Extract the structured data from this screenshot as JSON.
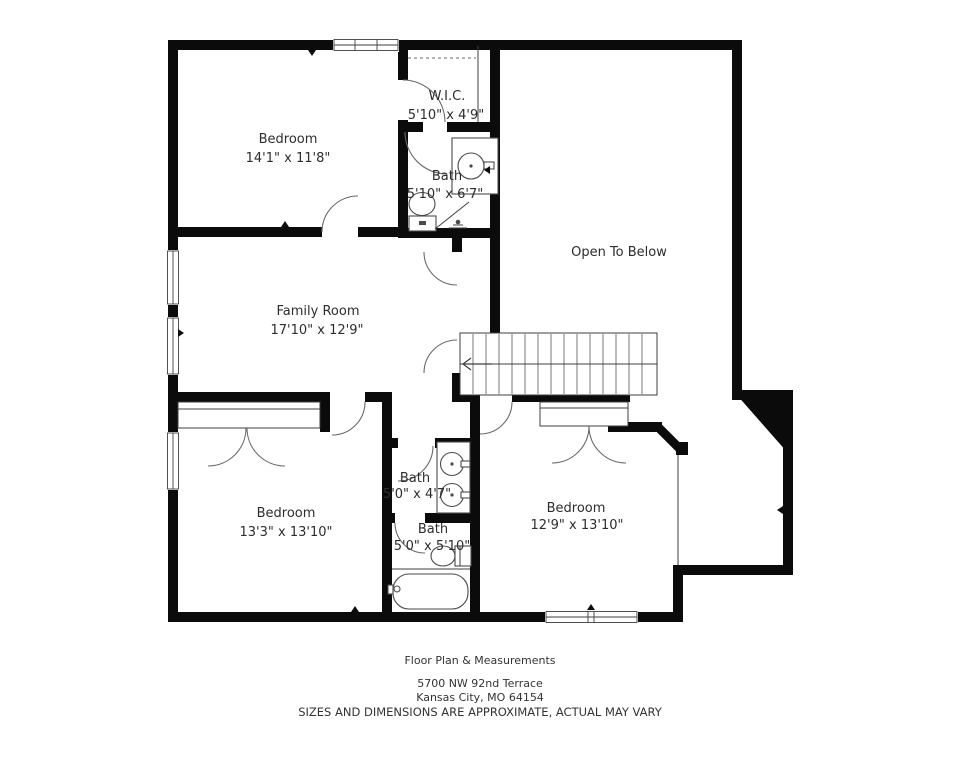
{
  "plan": {
    "rooms": {
      "bedroom1": {
        "name": "Bedroom",
        "dims": "14'1\" x 11'8\""
      },
      "wic": {
        "name": "W.I.C.",
        "dims": "5'10\" x 4'9\""
      },
      "bath_top": {
        "name": "Bath",
        "dims": "5'10\" x 6'7\""
      },
      "open_below": {
        "name": "Open To Below"
      },
      "family": {
        "name": "Family Room",
        "dims": "17'10\" x 12'9\""
      },
      "bedroom3": {
        "name": "Bedroom",
        "dims": "13'3\" x 13'10\""
      },
      "bath_mid": {
        "name": "Bath",
        "dims": "5'0\" x 4'7\""
      },
      "bath_low": {
        "name": "Bath",
        "dims": "5'0\" x 5'10\""
      },
      "bedroom2": {
        "name": "Bedroom",
        "dims": "12'9\" x 13'10\""
      }
    },
    "footer": {
      "title": "Floor Plan & Measurements",
      "address_line1": "5700 NW 92nd Terrace",
      "address_line2": "Kansas City, MO 64154",
      "disclaimer": "SIZES AND DIMENSIONS ARE APPROXIMATE, ACTUAL MAY VARY"
    },
    "colors": {
      "wall": "#0b0b0b",
      "fixture_line": "#4a4a4a",
      "text": "#2d2d2d",
      "background": "#ffffff"
    }
  }
}
